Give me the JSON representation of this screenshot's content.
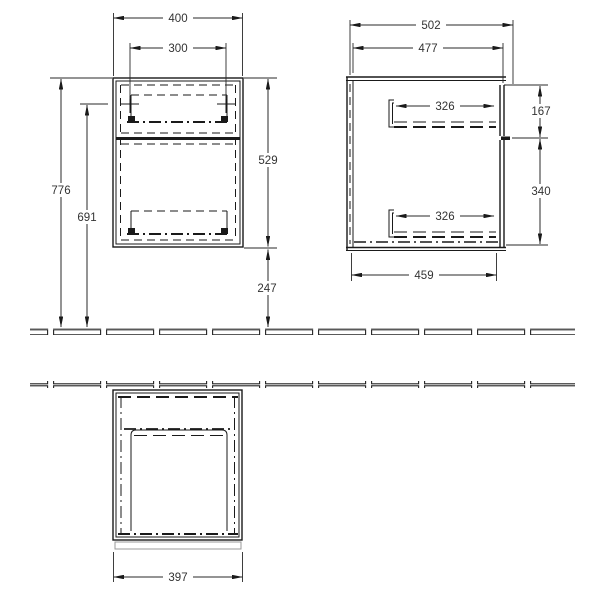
{
  "drawing": {
    "front_view": {
      "width": "400",
      "handle_width": "300",
      "total_height": "776",
      "handle_height": "691",
      "body_height": "529",
      "floor_clearance": "247"
    },
    "side_view": {
      "total_depth": "502",
      "body_depth": "477",
      "top_drawer_depth": "326",
      "bottom_drawer_depth": "326",
      "top_front_height": "167",
      "bottom_front_height": "340",
      "bottom_depth": "459"
    },
    "top_view": {
      "front_width": "397"
    },
    "colors": {
      "line": "#1a1a1a",
      "label": "#333333",
      "front_panel_outline": "#999999"
    }
  }
}
